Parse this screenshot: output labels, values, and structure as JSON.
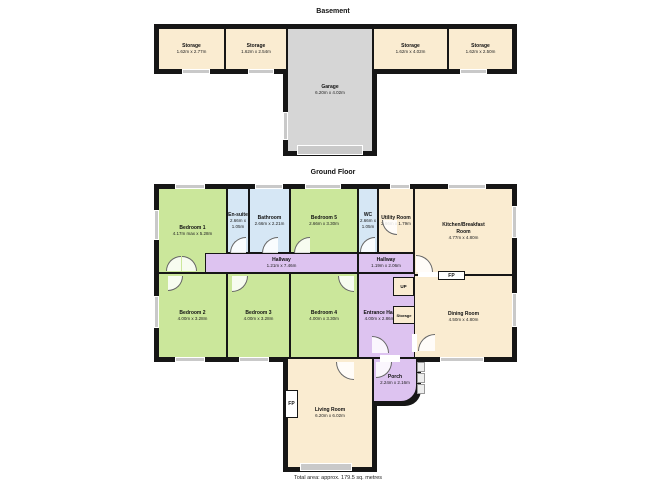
{
  "titles": {
    "basement": "Basement",
    "ground": "Ground Floor",
    "footer": "Total area: approx. 179.5 sq. metres"
  },
  "colors": {
    "room_cream": "#faecd1",
    "room_green": "#cbe79b",
    "room_blue": "#d6e7f5",
    "hall_purple": "#ddc3f0",
    "garage_grey": "#d6d6d6",
    "wall": "#161616",
    "window": "#c9c9c9"
  },
  "basement": {
    "storage1": {
      "name": "Storage",
      "dims": "1.62m x 2.77m"
    },
    "storage2": {
      "name": "Storage",
      "dims": "1.62m x 2.54m"
    },
    "storage3": {
      "name": "Storage",
      "dims": "1.62m x 4.02m"
    },
    "storage4": {
      "name": "Storage",
      "dims": "1.62m x 2.50m"
    },
    "garage": {
      "name": "Garage",
      "dims": "6.20m x 4.02m"
    }
  },
  "ground": {
    "bedroom1": {
      "name": "Bedroom 1",
      "dims": "4.17m max x 5.28m"
    },
    "ensuite": {
      "name": "En-suite",
      "dims": "2.66m x 1.05m"
    },
    "bathroom": {
      "name": "Bathroom",
      "dims": "2.66m x 2.21m"
    },
    "bedroom5": {
      "name": "Bedroom 5",
      "dims": "2.66m x 3.30m"
    },
    "wc": {
      "name": "WC",
      "dims": "2.66m x 1.05m"
    },
    "utility": {
      "name": "Utility Room",
      "dims": "2.66m x 1.79m"
    },
    "kitchen": {
      "name": "Kitchen/Breakfast Room",
      "dims": "4.77m x 4.80m"
    },
    "hallway1": {
      "name": "Hallway",
      "dims": "1.21m x 7.46m"
    },
    "hallway2": {
      "name": "Hallway",
      "dims": "1.19m x 2.06m"
    },
    "bedroom2": {
      "name": "Bedroom 2",
      "dims": "4.00m x 3.28m"
    },
    "bedroom3": {
      "name": "Bedroom 3",
      "dims": "4.00m x 3.28m"
    },
    "bedroom4": {
      "name": "Bedroom 4",
      "dims": "4.00m x 3.30m"
    },
    "entrance": {
      "name": "Entrance Hall",
      "dims": "4.00m x 2.86m"
    },
    "up": {
      "name": "UP"
    },
    "storage": {
      "name": "Storage"
    },
    "dining": {
      "name": "Dining Room",
      "dims": "4.50m x 4.80m"
    },
    "living": {
      "name": "Living Room",
      "dims": "6.20m x 6.02m"
    },
    "porch": {
      "name": "Porch",
      "dims": "2.24m x 2.16m"
    },
    "fireplace_label": "FP"
  }
}
